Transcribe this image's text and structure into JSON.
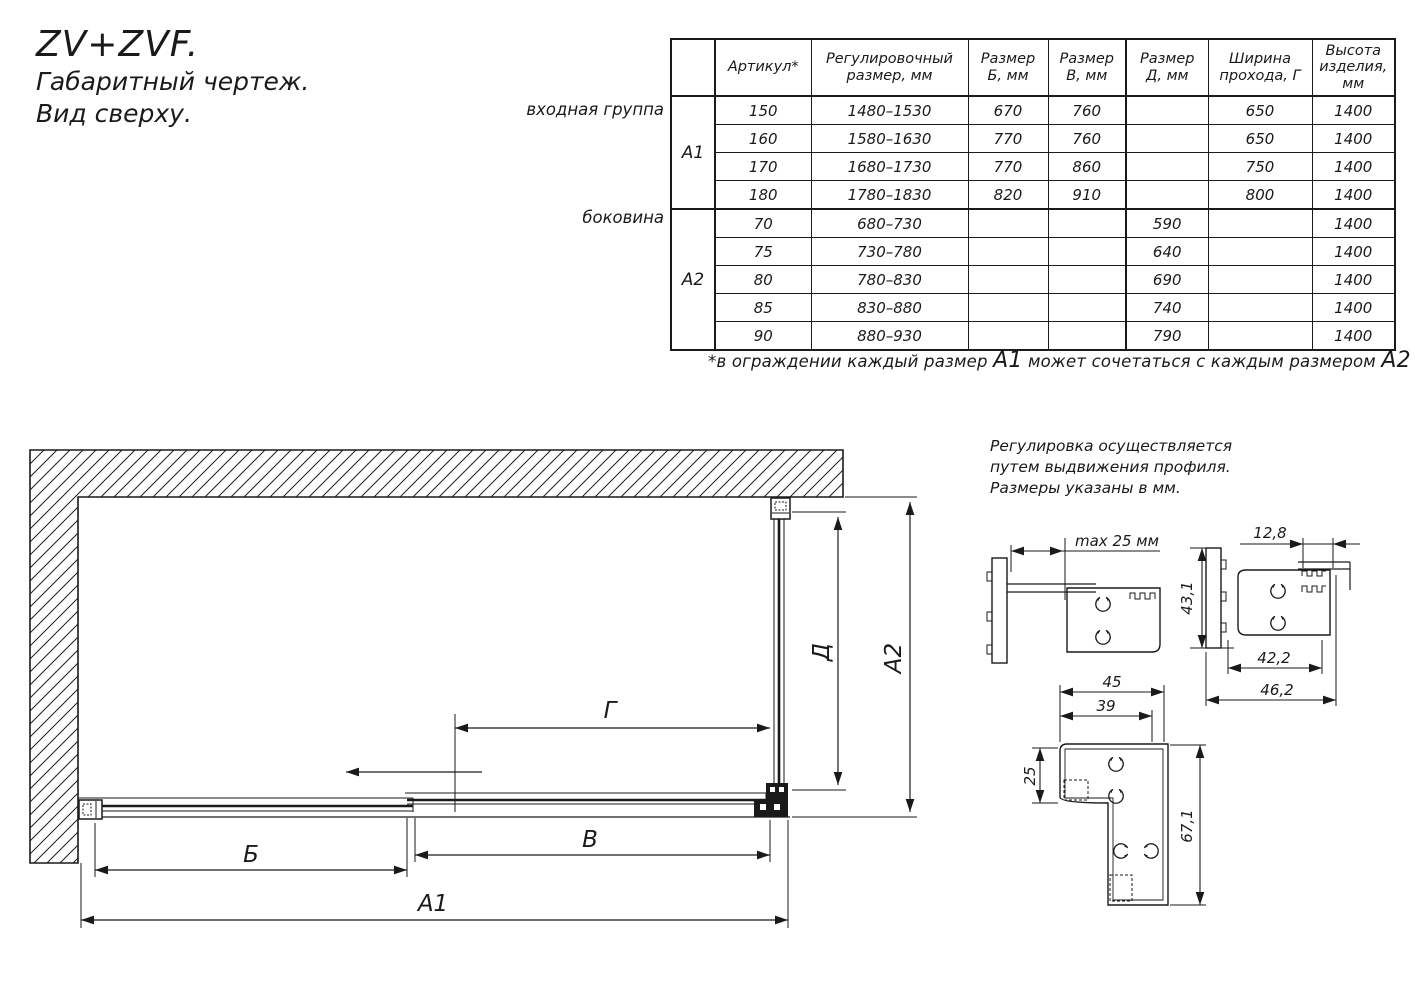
{
  "title": {
    "model": "ZV+ZVF.",
    "subtitle1": "Габаритный чертеж.",
    "subtitle2": "Вид сверху."
  },
  "table": {
    "headers": {
      "artikul": "Артикул*",
      "reg": "Регулировочный\nразмер, мм",
      "b": "Размер\nБ, мм",
      "v": "Размер\nВ, мм",
      "d": "Размер\nД, мм",
      "g": "Ширина\nпрохода, Г",
      "h": "Высота\nизделия,\nмм"
    },
    "groups": [
      {
        "label": "входная группа",
        "code": "А1",
        "rows": [
          [
            "150",
            "1480–1530",
            "670",
            "760",
            "",
            "650",
            "1400"
          ],
          [
            "160",
            "1580–1630",
            "770",
            "760",
            "",
            "650",
            "1400"
          ],
          [
            "170",
            "1680–1730",
            "770",
            "860",
            "",
            "750",
            "1400"
          ],
          [
            "180",
            "1780–1830",
            "820",
            "910",
            "",
            "800",
            "1400"
          ]
        ]
      },
      {
        "label": "боковина",
        "code": "А2",
        "rows": [
          [
            "70",
            "680–730",
            "",
            "",
            "590",
            "",
            "1400"
          ],
          [
            "75",
            "730–780",
            "",
            "",
            "640",
            "",
            "1400"
          ],
          [
            "80",
            "780–830",
            "",
            "",
            "690",
            "",
            "1400"
          ],
          [
            "85",
            "830–880",
            "",
            "",
            "740",
            "",
            "1400"
          ],
          [
            "90",
            "880–930",
            "",
            "",
            "790",
            "",
            "1400"
          ]
        ]
      }
    ]
  },
  "footnote": {
    "part1": "*в ограждении каждый размер ",
    "a1": "А1",
    "part2": " может сочетаться с каждым размером ",
    "a2": "А2"
  },
  "note": {
    "line1": "Регулировка осуществляется",
    "line2": "путем выдвижения профиля.",
    "line3": "Размеры указаны в мм."
  },
  "drawing": {
    "dim_b": "Б",
    "dim_v": "В",
    "dim_a1": "А1",
    "dim_g": "Г",
    "dim_d": "Д",
    "dim_a2": "А2"
  },
  "details": {
    "max25": "max 25 мм",
    "w12_8": "12,8",
    "h43_1": "43,1",
    "w42_2": "42,2",
    "w46_2": "46,2",
    "w45": "45",
    "w39": "39",
    "h25": "25",
    "h67_1": "67,1"
  }
}
